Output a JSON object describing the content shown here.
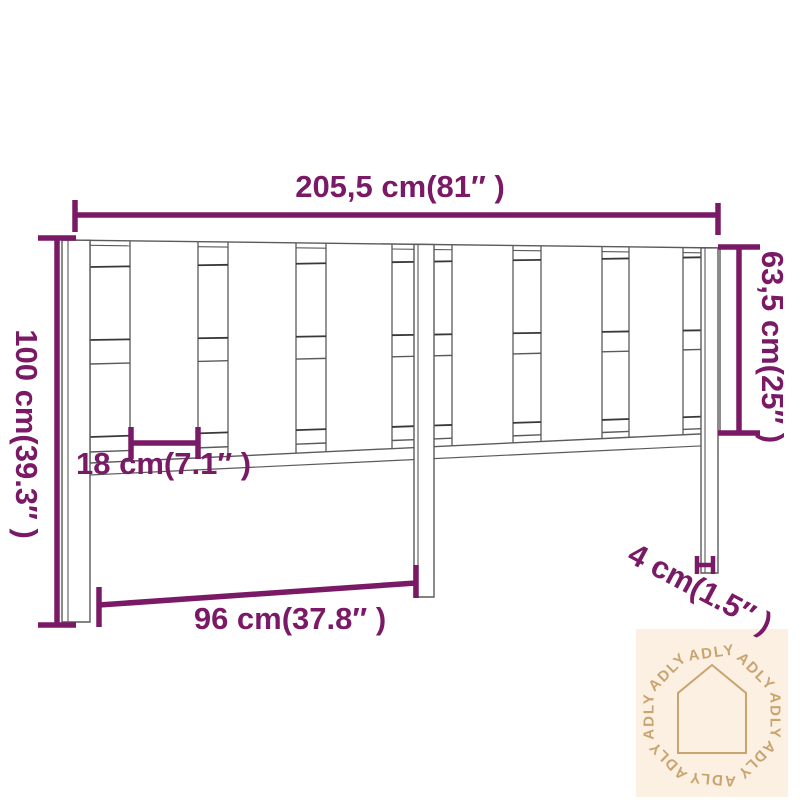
{
  "dimensions": {
    "total_width": "205,5 cm(81″ )",
    "total_height": "100 cm(39.3″ )",
    "headboard_height": "63,5 cm(25″ )",
    "slat_width": "18 cm(7.1″ )",
    "leg_spacing": "96 cm(37.8″ )",
    "leg_thickness": "4 cm(1.5″ )"
  },
  "watermark": {
    "brand": "ADLY",
    "icon": "house-icon"
  },
  "colors": {
    "dimension_accent": "#7A1A66",
    "line_art": "#5a5a5a",
    "line_art_dark": "#383838",
    "watermark_background": "#FBF0E1",
    "watermark_foreground": "#C9A470"
  }
}
